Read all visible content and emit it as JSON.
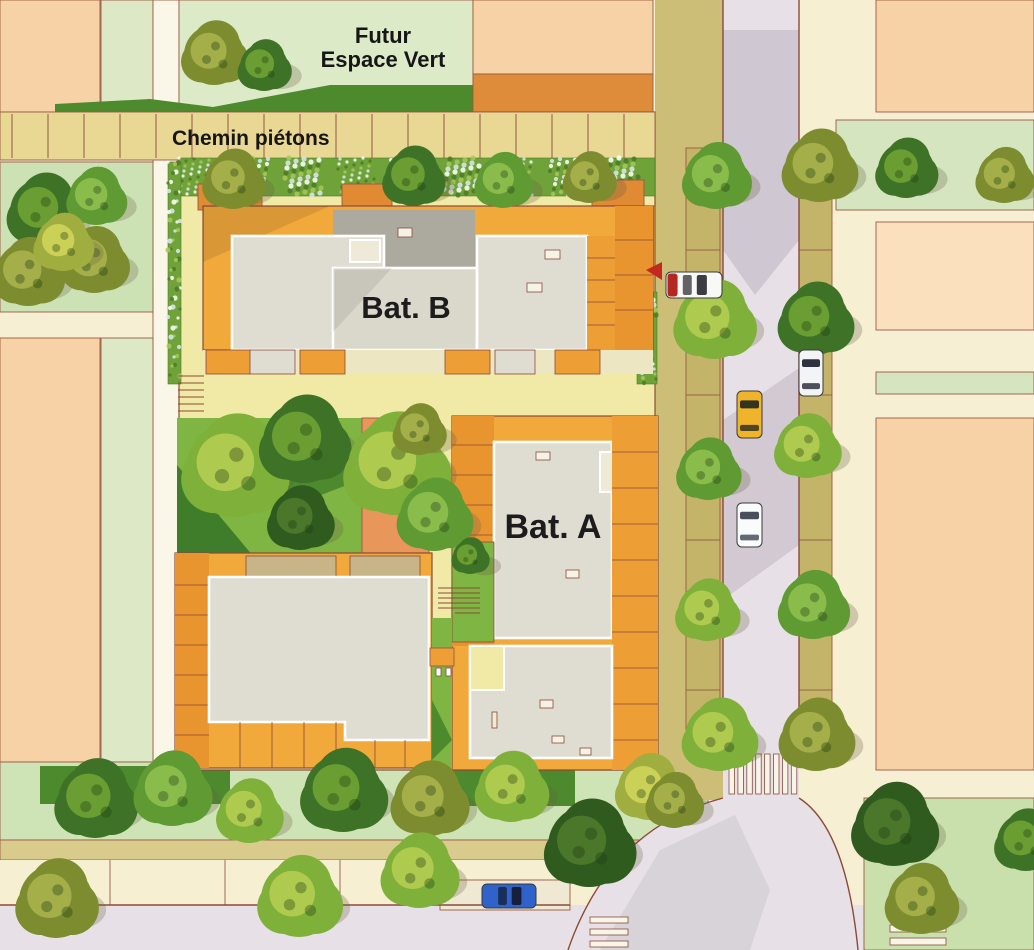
{
  "labels": {
    "future_green_space_line1": "Futur",
    "future_green_space_line2": "Espace Vert",
    "pedestrian_path": "Chemin piétons",
    "building_b": "Bat. B",
    "building_a": "Bat. A"
  },
  "palette": {
    "background_cream": "#F6EFD3",
    "site_ground": "#F1EAA6",
    "peach_block": "#F8D2A7",
    "peach_light": "#FAE0BD",
    "mint_strip": "#DCE8C6",
    "green_strip": "#D5E5BF",
    "future_green": "#DCEAC8",
    "meadow_dark": "#4C8A2D",
    "lawn": "#7FB542",
    "lawn_dark": "#3F7D2A",
    "balcony_orange": "#F2A93C",
    "balcony_deep": "#E8952F",
    "amber_block": "#D6932F",
    "terracotta_path": "#E8965A",
    "orange_band": "#DE8C3A",
    "roof_light": "#DFDCD1",
    "roof_mid": "#DAD7CB",
    "roof_dark": "#ACA99E",
    "road": "#E7E1E7",
    "road_shadow": "#B7AEBB",
    "sidewalk_cream": "#F6EFD2",
    "khaki_strip": "#CCBE77",
    "parking_tan": "#E8D894",
    "curb_brown": "#8A4A3A",
    "crosswalk_white": "#F7F4E8",
    "arrow_red": "#C2281E",
    "hedge": {
      "base": "#6FA33A",
      "dots": [
        "#FFFFFF",
        "#DDE8F2",
        "#A9C85A",
        "#4C7A28"
      ]
    },
    "tree": {
      "dark": [
        "#3E7226",
        "#6FA335"
      ],
      "olive": [
        "#7D8C2F",
        "#A8B34C"
      ],
      "mid": [
        "#5F9A33",
        "#8FC04F"
      ],
      "bright": [
        "#7FB03A",
        "#B5CE52"
      ],
      "yellow": [
        "#9FAE3F",
        "#CFD45A"
      ],
      "deep": [
        "#2F5B1E",
        "#4E7A2B"
      ]
    }
  },
  "scene": {
    "trees": [
      {
        "x": 214,
        "y": 55,
        "r": 30,
        "c": "olive"
      },
      {
        "x": 264,
        "y": 67,
        "r": 24,
        "c": "dark"
      },
      {
        "x": 44,
        "y": 212,
        "r": 34,
        "c": "dark"
      },
      {
        "x": 96,
        "y": 198,
        "r": 27,
        "c": "mid"
      },
      {
        "x": 28,
        "y": 274,
        "r": 32,
        "c": "olive"
      },
      {
        "x": 94,
        "y": 262,
        "r": 31,
        "c": "olive"
      },
      {
        "x": 63,
        "y": 244,
        "r": 27,
        "c": "yellow"
      },
      {
        "x": 233,
        "y": 181,
        "r": 28,
        "c": "olive"
      },
      {
        "x": 413,
        "y": 178,
        "r": 28,
        "c": "dark"
      },
      {
        "x": 503,
        "y": 182,
        "r": 26,
        "c": "mid"
      },
      {
        "x": 589,
        "y": 179,
        "r": 24,
        "c": "olive"
      },
      {
        "x": 716,
        "y": 178,
        "r": 31,
        "c": "mid"
      },
      {
        "x": 714,
        "y": 322,
        "r": 37,
        "c": "bright"
      },
      {
        "x": 708,
        "y": 471,
        "r": 29,
        "c": "mid"
      },
      {
        "x": 707,
        "y": 612,
        "r": 29,
        "c": "bright"
      },
      {
        "x": 719,
        "y": 737,
        "r": 34,
        "c": "bright"
      },
      {
        "x": 819,
        "y": 168,
        "r": 34,
        "c": "olive"
      },
      {
        "x": 815,
        "y": 321,
        "r": 34,
        "c": "dark"
      },
      {
        "x": 807,
        "y": 448,
        "r": 30,
        "c": "bright"
      },
      {
        "x": 813,
        "y": 607,
        "r": 32,
        "c": "mid"
      },
      {
        "x": 816,
        "y": 737,
        "r": 34,
        "c": "olive"
      },
      {
        "x": 906,
        "y": 170,
        "r": 28,
        "c": "dark"
      },
      {
        "x": 1004,
        "y": 177,
        "r": 26,
        "c": "olive"
      },
      {
        "x": 234,
        "y": 469,
        "r": 48,
        "c": "bright"
      },
      {
        "x": 304,
        "y": 442,
        "r": 41,
        "c": "dark"
      },
      {
        "x": 396,
        "y": 467,
        "r": 48,
        "c": "bright"
      },
      {
        "x": 434,
        "y": 517,
        "r": 34,
        "c": "mid"
      },
      {
        "x": 419,
        "y": 431,
        "r": 24,
        "c": "olive"
      },
      {
        "x": 300,
        "y": 520,
        "r": 30,
        "c": "deep"
      },
      {
        "x": 470,
        "y": 557,
        "r": 17,
        "c": "dark"
      },
      {
        "x": 95,
        "y": 801,
        "r": 37,
        "c": "dark"
      },
      {
        "x": 172,
        "y": 791,
        "r": 35,
        "c": "mid"
      },
      {
        "x": 249,
        "y": 813,
        "r": 30,
        "c": "bright"
      },
      {
        "x": 343,
        "y": 793,
        "r": 39,
        "c": "dark"
      },
      {
        "x": 429,
        "y": 801,
        "r": 35,
        "c": "olive"
      },
      {
        "x": 511,
        "y": 789,
        "r": 33,
        "c": "bright"
      },
      {
        "x": 589,
        "y": 846,
        "r": 41,
        "c": "deep"
      },
      {
        "x": 649,
        "y": 789,
        "r": 31,
        "c": "yellow"
      },
      {
        "x": 674,
        "y": 802,
        "r": 26,
        "c": "olive"
      },
      {
        "x": 56,
        "y": 901,
        "r": 37,
        "c": "olive"
      },
      {
        "x": 299,
        "y": 899,
        "r": 38,
        "c": "bright"
      },
      {
        "x": 419,
        "y": 873,
        "r": 35,
        "c": "bright"
      },
      {
        "x": 894,
        "y": 827,
        "r": 39,
        "c": "deep"
      },
      {
        "x": 921,
        "y": 901,
        "r": 33,
        "c": "olive"
      },
      {
        "x": 1026,
        "y": 842,
        "r": 29,
        "c": "dark"
      }
    ],
    "cars": [
      {
        "name": "delivery-van",
        "x": 666,
        "y": 272,
        "w": 56,
        "h": 26,
        "dir": "h",
        "body": "#F8F8F6",
        "glass": "#3C3C44",
        "accent": "#B5281F"
      },
      {
        "name": "yellow-car",
        "x": 737,
        "y": 391,
        "w": 25,
        "h": 47,
        "dir": "v",
        "body": "#F0B42B",
        "glass": "#33331F"
      },
      {
        "name": "white-cabriolet",
        "x": 799,
        "y": 350,
        "w": 24,
        "h": 46,
        "dir": "v",
        "body": "#F2F4F6",
        "glass": "#2F3340"
      },
      {
        "name": "white-car",
        "x": 737,
        "y": 503,
        "w": 25,
        "h": 44,
        "dir": "v",
        "body": "#FAFBFC",
        "glass": "#49505C"
      },
      {
        "name": "parked-blue-car",
        "x": 482,
        "y": 884,
        "w": 54,
        "h": 24,
        "dir": "h",
        "body": "#2F63C9",
        "glass": "#16203A"
      }
    ],
    "crosswalks": [
      {
        "x": 729,
        "y": 754,
        "dir": "v",
        "count": 8,
        "sw": 5.5,
        "sl": 40,
        "gap": 3.4
      },
      {
        "x": 890,
        "y": 899,
        "dir": "h",
        "count": 4,
        "sw": 7,
        "sl": 56,
        "gap": 6
      },
      {
        "x": 590,
        "y": 917,
        "dir": "h",
        "count": 3,
        "sw": 6,
        "sl": 38,
        "gap": 6
      }
    ],
    "hedges": [
      {
        "x": 179,
        "y": 158,
        "w": 476,
        "h": 38
      },
      {
        "x": 168,
        "y": 162,
        "w": 13,
        "h": 222
      },
      {
        "x": 637,
        "y": 292,
        "w": 20,
        "h": 92
      }
    ],
    "parking_lines": {
      "x0": 12,
      "dx": 36,
      "count": 18,
      "y1": 114,
      "y2": 158
    }
  }
}
